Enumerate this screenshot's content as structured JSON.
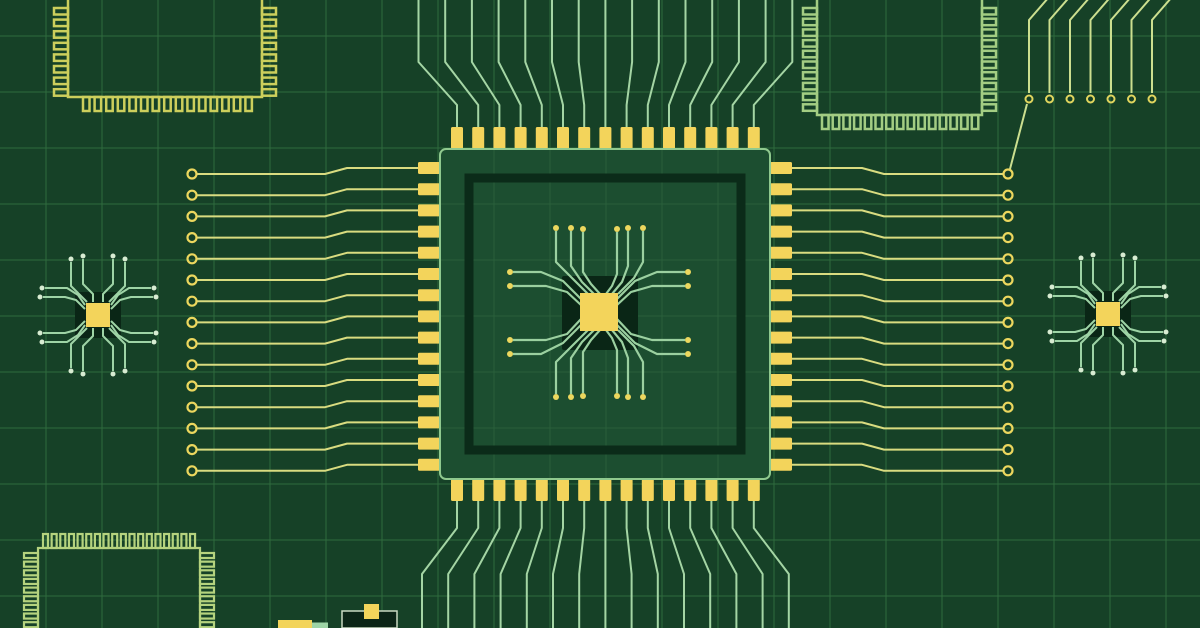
{
  "illustration": {
    "canvas": {
      "w": 1200,
      "h": 628
    },
    "colors": {
      "background": "#164127",
      "grid": "#2f6b3d",
      "gridOnChip": "#2a5f3a",
      "chipBody": "#1c4e30",
      "chipOutline": "#8fc98e",
      "innerRing": "#0b2b19",
      "pin": "#f3d45b",
      "die": "#f3d45b",
      "pad": "#0a2616",
      "dieTrace": "#9bd0a0",
      "dieDot": "#ecd75e",
      "traceYellow": "#d9dc80",
      "ringYellow": "#ecd75e",
      "fanGreen": "#a4d5a4",
      "trTrace": "#ccdf8f",
      "trRing": "#e0d55e",
      "spiderTrace": "#9ed4a6",
      "spiderTip": "#d8ecd2",
      "cornerTL": "#cccf5c",
      "cornerTR": "#a3cd83",
      "cornerBL": "#b5d37e",
      "componentDark": "#0c2517",
      "componentOutline": "#c9d9c2"
    },
    "grid": {
      "pitch": 56,
      "offsetX": 46,
      "offsetY": 36
    },
    "centerChip": {
      "body": {
        "x": 440,
        "y": 149,
        "w": 330,
        "h": 330
      },
      "innerRing": {
        "x": 469,
        "y": 178,
        "w": 272,
        "h": 272,
        "stroke": 9
      },
      "pinCount": 15,
      "pinStart": 457,
      "pinPitch": 21.2,
      "pinW": 12,
      "pinLen": 22,
      "leftPinY0": 168,
      "topPinY": 127,
      "bottomPinY": 479,
      "leftPinX": 418,
      "rightPinX": 770,
      "pad": {
        "x": 562,
        "y": 276,
        "w": 76,
        "h": 74
      },
      "die": {
        "x": 580,
        "y": 293,
        "w": 38,
        "h": 38
      }
    },
    "dieTraces": [
      {
        "p": [
          [
            588,
            294
          ],
          [
            572,
            278
          ],
          [
            556,
            262
          ],
          [
            556,
            231
          ]
        ],
        "d": [
          556,
          228
        ]
      },
      {
        "p": [
          [
            594,
            294
          ],
          [
            582,
            282
          ],
          [
            571,
            266
          ],
          [
            571,
            231
          ]
        ],
        "d": [
          571,
          228
        ]
      },
      {
        "p": [
          [
            600,
            294
          ],
          [
            591,
            284
          ],
          [
            583,
            272
          ],
          [
            583,
            232
          ]
        ],
        "d": [
          583,
          229
        ]
      },
      {
        "p": [
          [
            606,
            294
          ],
          [
            612,
            286
          ],
          [
            617,
            274
          ],
          [
            617,
            232
          ]
        ],
        "d": [
          617,
          229
        ]
      },
      {
        "p": [
          [
            612,
            294
          ],
          [
            622,
            282
          ],
          [
            628,
            266
          ],
          [
            628,
            231
          ]
        ],
        "d": [
          628,
          228
        ]
      },
      {
        "p": [
          [
            618,
            294
          ],
          [
            634,
            278
          ],
          [
            643,
            262
          ],
          [
            643,
            231
          ]
        ],
        "d": [
          643,
          228
        ]
      },
      {
        "p": [
          [
            588,
            330
          ],
          [
            572,
            346
          ],
          [
            556,
            362
          ],
          [
            556,
            394
          ]
        ],
        "d": [
          556,
          397
        ]
      },
      {
        "p": [
          [
            594,
            330
          ],
          [
            582,
            342
          ],
          [
            571,
            358
          ],
          [
            571,
            394
          ]
        ],
        "d": [
          571,
          397
        ]
      },
      {
        "p": [
          [
            600,
            330
          ],
          [
            591,
            340
          ],
          [
            583,
            352
          ],
          [
            583,
            393
          ]
        ],
        "d": [
          583,
          396
        ]
      },
      {
        "p": [
          [
            606,
            330
          ],
          [
            612,
            338
          ],
          [
            617,
            350
          ],
          [
            617,
            393
          ]
        ],
        "d": [
          617,
          396
        ]
      },
      {
        "p": [
          [
            612,
            330
          ],
          [
            622,
            342
          ],
          [
            628,
            358
          ],
          [
            628,
            394
          ]
        ],
        "d": [
          628,
          397
        ]
      },
      {
        "p": [
          [
            618,
            330
          ],
          [
            634,
            346
          ],
          [
            643,
            362
          ],
          [
            643,
            394
          ]
        ],
        "d": [
          643,
          397
        ]
      },
      {
        "p": [
          [
            581,
            299
          ],
          [
            563,
            281
          ],
          [
            541,
            272
          ],
          [
            513,
            272
          ]
        ],
        "d": [
          510,
          272
        ]
      },
      {
        "p": [
          [
            581,
            305
          ],
          [
            567,
            292
          ],
          [
            546,
            286
          ],
          [
            513,
            286
          ]
        ],
        "d": [
          510,
          286
        ]
      },
      {
        "p": [
          [
            581,
            319
          ],
          [
            567,
            334
          ],
          [
            546,
            340
          ],
          [
            513,
            340
          ]
        ],
        "d": [
          510,
          340
        ]
      },
      {
        "p": [
          [
            581,
            325
          ],
          [
            563,
            343
          ],
          [
            541,
            354
          ],
          [
            513,
            354
          ]
        ],
        "d": [
          510,
          354
        ]
      },
      {
        "p": [
          [
            617,
            299
          ],
          [
            635,
            281
          ],
          [
            657,
            272
          ],
          [
            685,
            272
          ]
        ],
        "d": [
          688,
          272
        ]
      },
      {
        "p": [
          [
            617,
            305
          ],
          [
            631,
            292
          ],
          [
            652,
            286
          ],
          [
            685,
            286
          ]
        ],
        "d": [
          688,
          286
        ]
      },
      {
        "p": [
          [
            617,
            319
          ],
          [
            631,
            334
          ],
          [
            652,
            340
          ],
          [
            685,
            340
          ]
        ],
        "d": [
          688,
          340
        ]
      },
      {
        "p": [
          [
            617,
            325
          ],
          [
            635,
            343
          ],
          [
            657,
            354
          ],
          [
            685,
            354
          ]
        ],
        "d": [
          688,
          354
        ]
      }
    ],
    "sideTraces": {
      "left": {
        "count": 15,
        "ringX": 192,
        "ringY0": 174,
        "pitch": 21.2,
        "dy": -6,
        "xs": [
          196,
          325,
          347,
          418
        ]
      },
      "right": {
        "count": 15,
        "ringX": 1008,
        "ringY0": 174,
        "pitch": 21.2,
        "dy": -6,
        "xs": [
          792,
          862,
          884,
          1003
        ]
      }
    },
    "fans": {
      "top": {
        "y0": 128,
        "y1": 105,
        "y2": 62,
        "y3": -3,
        "spread": 5.5,
        "centerIndex": 7
      },
      "bottom": {
        "y0": 500,
        "y1": 528,
        "y2": 574,
        "y3": 631,
        "spread": 5.0,
        "centerIndex": 7
      }
    },
    "topRightTraces": {
      "count": 7,
      "x0": 1029,
      "pitch": 20.5,
      "topBendX": 20,
      "topY": -3,
      "bendY": 20,
      "lineEndY": 93,
      "ringY": 99,
      "ringR": 3.5,
      "connector": [
        [
          1027,
          104
        ],
        [
          1010,
          169
        ]
      ]
    },
    "cornerChips": [
      {
        "name": "outline-chip-top-left",
        "colorKey": "cornerTL",
        "strokeWidth": 2.5,
        "body": {
          "x": 68,
          "y": -40,
          "w": 194,
          "h": 137
        },
        "pinLen": 14,
        "pinThick": 6.5,
        "combs": [
          {
            "side": "left",
            "from": 8,
            "count": 8,
            "pitch": 11.6
          },
          {
            "side": "right",
            "from": 8,
            "count": 8,
            "pitch": 11.6
          },
          {
            "side": "bottom",
            "from": 83,
            "count": 15,
            "pitch": 11.6
          }
        ]
      },
      {
        "name": "outline-chip-top-right",
        "colorKey": "cornerTR",
        "strokeWidth": 2.5,
        "body": {
          "x": 817,
          "y": -40,
          "w": 165,
          "h": 155
        },
        "pinLen": 14,
        "pinThick": 6.5,
        "combs": [
          {
            "side": "left",
            "from": 8,
            "count": 10,
            "pitch": 10.7
          },
          {
            "side": "right",
            "from": 8,
            "count": 10,
            "pitch": 10.7
          },
          {
            "side": "bottom",
            "from": 822,
            "count": 15,
            "pitch": 10.7
          }
        ]
      },
      {
        "name": "outline-chip-bottom-left",
        "colorKey": "cornerBL",
        "strokeWidth": 2.2,
        "body": {
          "x": 38,
          "y": 548,
          "w": 162,
          "h": 95
        },
        "pinLen": 14,
        "pinThick": 5,
        "combs": [
          {
            "side": "top",
            "from": 43,
            "count": 18,
            "pitch": 8.65
          },
          {
            "side": "left",
            "from": 553,
            "count": 9,
            "pitch": 8.65
          },
          {
            "side": "right",
            "from": 553,
            "count": 9,
            "pitch": 8.65
          }
        ]
      }
    ],
    "spiderChips": [
      {
        "cx": 98,
        "cy": 315
      },
      {
        "cx": 1108,
        "cy": 314
      }
    ],
    "spiderGeom": {
      "padSize": 46,
      "dieSize": 24,
      "tipR": 2.5,
      "vert1": [
        [
          5,
          13
        ],
        [
          5,
          21
        ],
        [
          15,
          31
        ],
        [
          15,
          56
        ]
      ],
      "vert1Tip": [
        15,
        59
      ],
      "vert2": [
        [
          11,
          13
        ],
        [
          17,
          19
        ],
        [
          27,
          29
        ],
        [
          27,
          53
        ]
      ],
      "vert2Tip": [
        27,
        56
      ],
      "horiz1": [
        [
          13,
          6
        ],
        [
          22,
          15
        ],
        [
          33,
          18
        ],
        [
          55,
          18
        ]
      ],
      "horiz1Tip": [
        58,
        18
      ],
      "horiz2": [
        [
          13,
          10
        ],
        [
          20,
          20
        ],
        [
          31,
          27
        ],
        [
          53,
          27
        ]
      ],
      "horiz2Tip": [
        56,
        27
      ]
    },
    "smallComponents": [
      {
        "name": "smd-component-green-tab",
        "x": 312,
        "y": 622.5,
        "w": 16,
        "h": 5.5,
        "fillKey": "spiderTrace"
      },
      {
        "name": "smd-component-yellow-bar",
        "x": 278,
        "y": 620,
        "w": 34,
        "h": 8,
        "fillKey": "pin"
      },
      {
        "name": "smd-component-dark-box",
        "x": 342,
        "y": 611,
        "w": 55,
        "h": 17,
        "fillKey": "componentDark",
        "strokeKey": "componentOutline",
        "strokeWidth": 1.5
      },
      {
        "name": "smd-component-box-pad",
        "x": 364,
        "y": 604,
        "w": 15,
        "h": 15,
        "fillKey": "pin"
      }
    ]
  }
}
